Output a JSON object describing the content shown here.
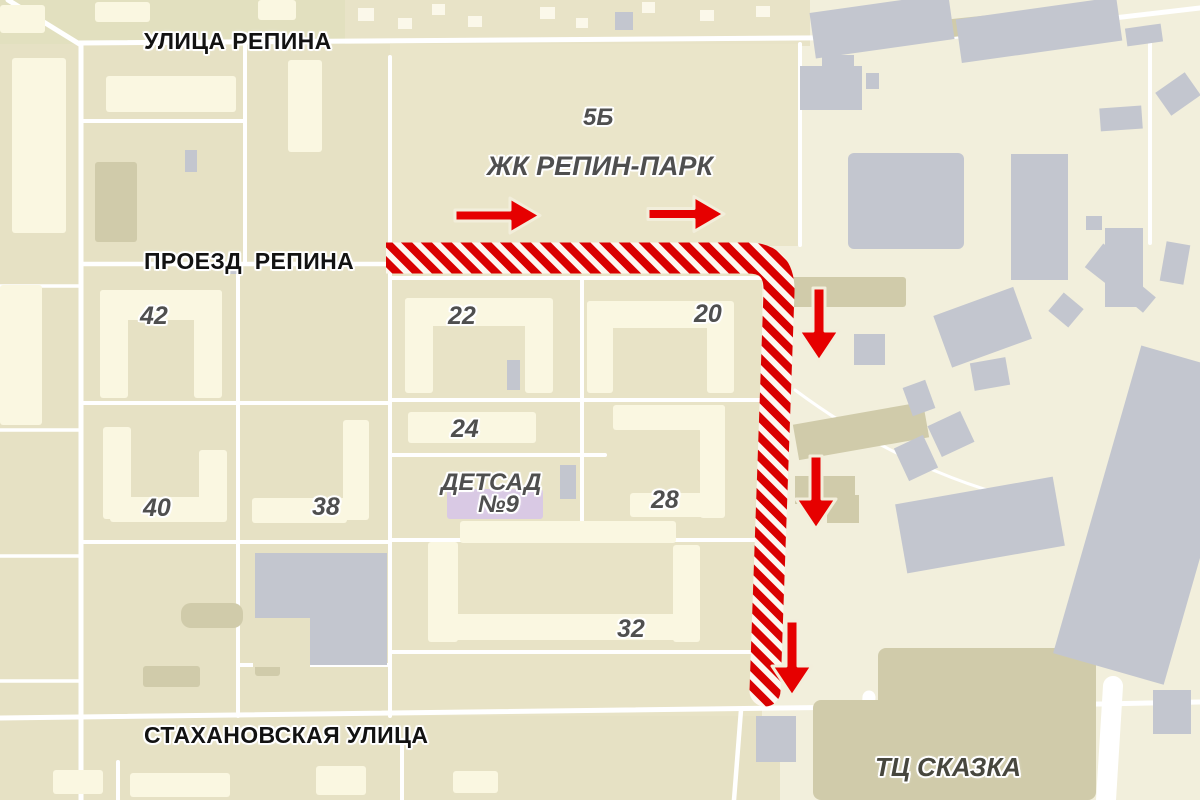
{
  "streets": {
    "ulitsa_repina": "УЛИЦА РЕПИНА",
    "proezd_repina": "ПРОЕЗД РЕПИНА",
    "stakhanovskaya": "СТАХАНОВСКАЯ УЛИЦА"
  },
  "places": {
    "block_5b": "5Б",
    "zhk_repin_park": "ЖК РЕПИН-ПАРК",
    "detsad_line1": "ДЕТСАД",
    "detsad_line2": "№9",
    "tc_skazka": "ТЦ СКАЗКА"
  },
  "house_numbers": {
    "h42": "42",
    "h22": "22",
    "h20": "20",
    "h24": "24",
    "h40": "40",
    "h38": "38",
    "h28": "28",
    "h32": "32"
  },
  "route": {
    "band_color": "#d90000",
    "stripe_color": "#fdf7f0",
    "arrow_color": "#e60000",
    "arrows": [
      {
        "direction": "right"
      },
      {
        "direction": "right"
      },
      {
        "direction": "down"
      },
      {
        "direction": "down"
      },
      {
        "direction": "down"
      }
    ]
  },
  "colors": {
    "background": "#f2efdc",
    "residential_block": "#e6e1c4",
    "zhk_block": "#eae5c9",
    "building_light": "#faf7e1",
    "building_gray": "#c3c6cf",
    "building_olive": "#d0cbaa",
    "building_lavender": "#d9c9e4",
    "road": "#ffffff",
    "street_label": "#121212",
    "poi_label": "#4f4f4f"
  }
}
